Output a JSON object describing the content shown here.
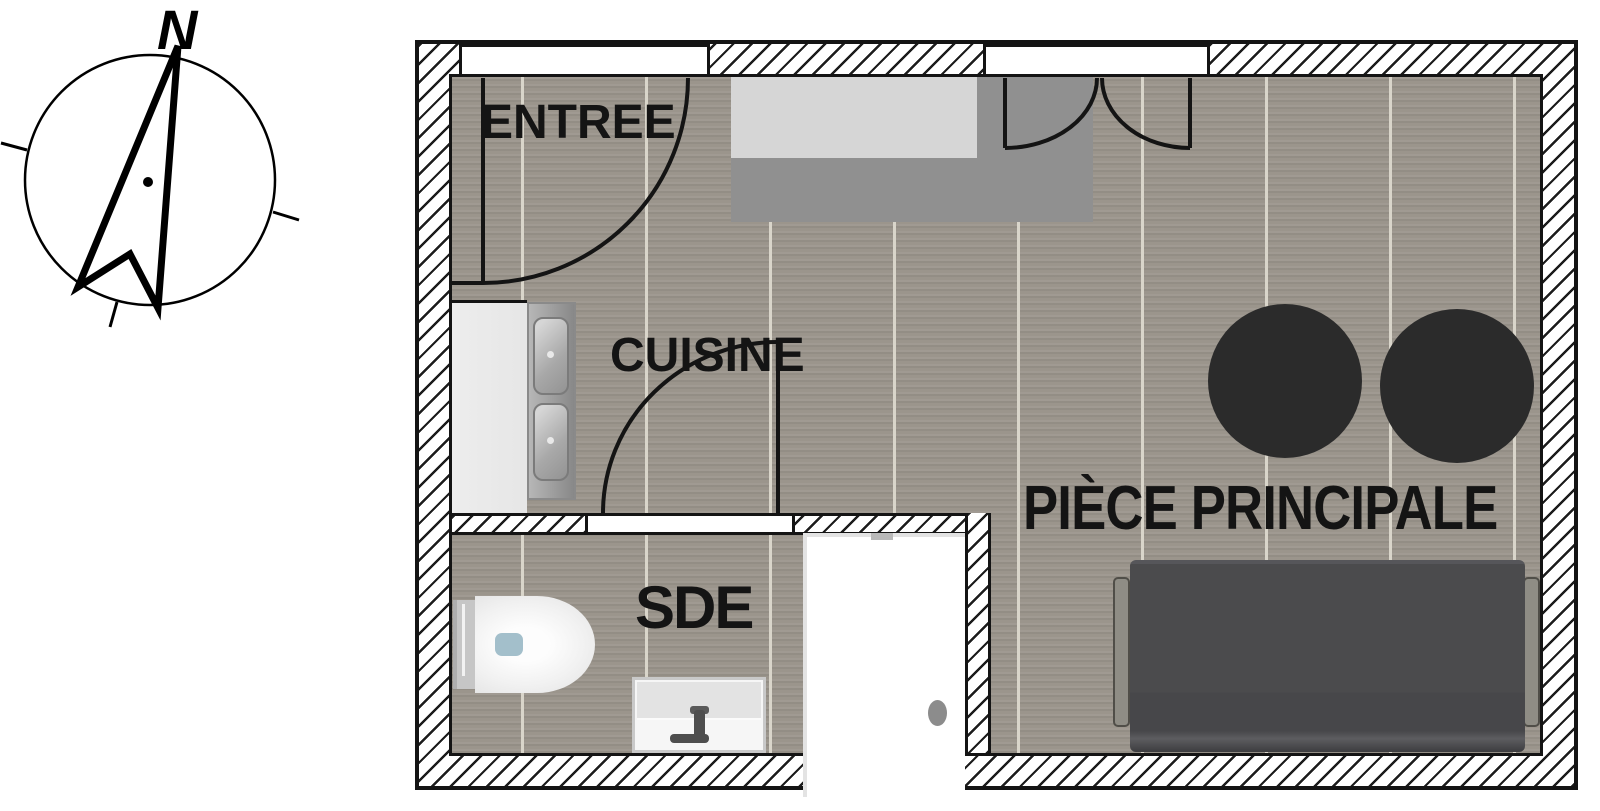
{
  "compass": {
    "north_label": "N"
  },
  "rooms": {
    "entree": {
      "label": "ENTREE"
    },
    "cuisine": {
      "label": "CUISINE"
    },
    "sde": {
      "label": "SDE"
    },
    "piece_principale": {
      "label": "PIÈCE PRINCIPALE"
    }
  },
  "fixtures": [
    "compass-rose",
    "entry-door-swing",
    "double-door-swing",
    "sde-door-swing",
    "entry-window-opening",
    "main-window-opening",
    "kitchen-counter",
    "kitchen-double-sink",
    "storage-unit",
    "toilet",
    "vanity-sink",
    "shower",
    "sofa-bed",
    "round-table",
    "round-table"
  ],
  "colors": {
    "floor": "#9b958c",
    "plank": "#d9d5ca",
    "hatch": "#1c1c1c",
    "wall_fill": "#ffffff",
    "outline": "#141414",
    "unit_dark": "#909090",
    "unit_light": "#d6d6d6",
    "counter": "#e6e6e6",
    "sofa": "#4b4b4d",
    "sofa_arm": "#8f8d85",
    "table": "#2b2b2b",
    "shower_drain": "#8c8c8c",
    "toilet_button": "#a3bfcb"
  }
}
